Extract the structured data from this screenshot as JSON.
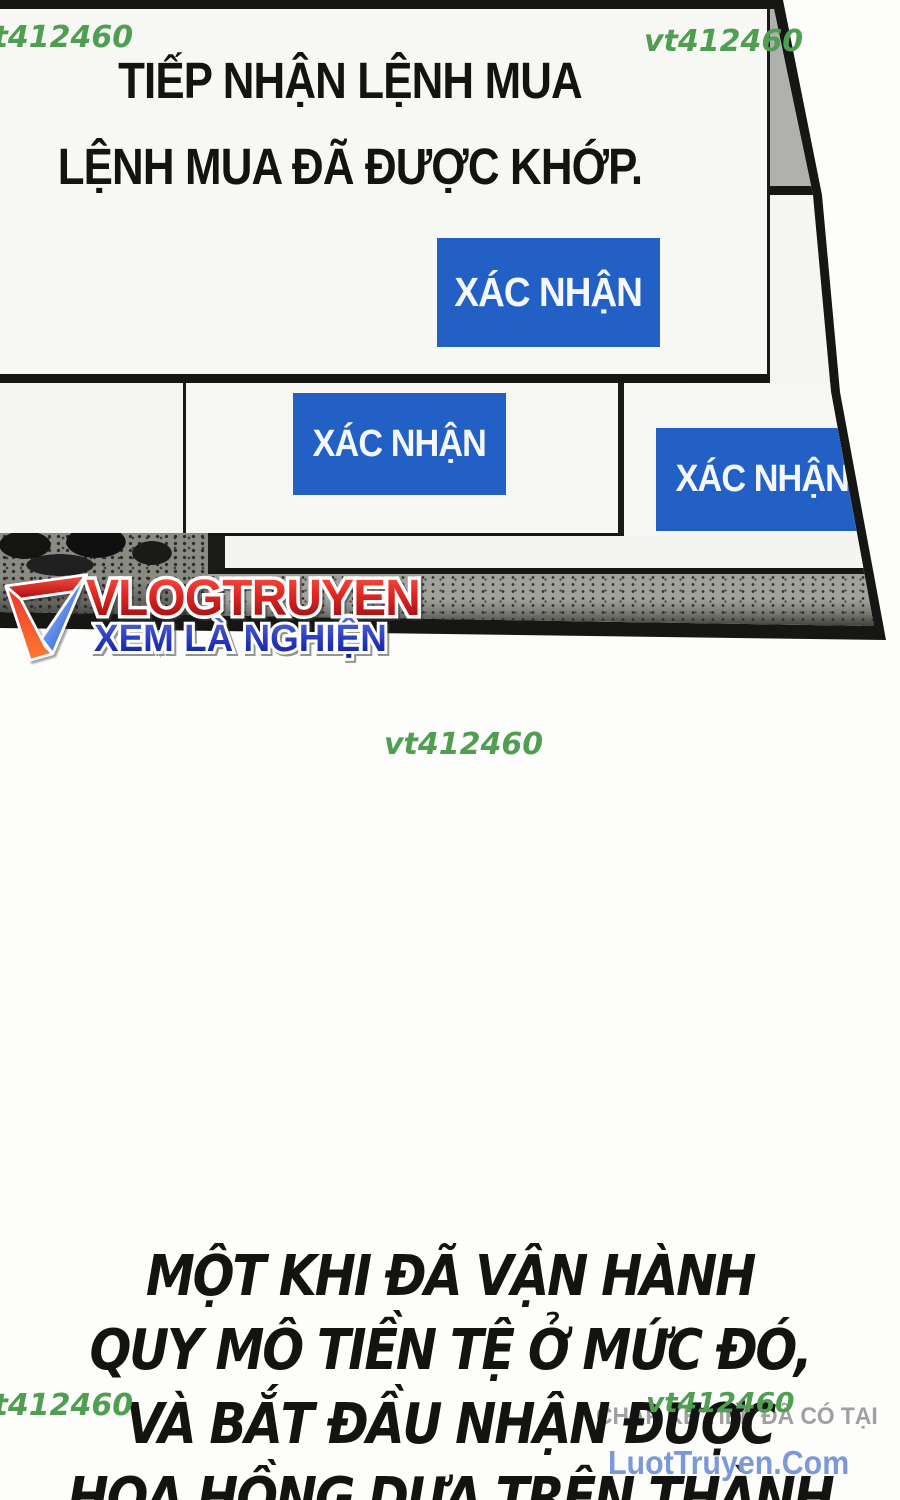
{
  "watermark": {
    "text": "vt412460",
    "color": "#4f9e51"
  },
  "popup": {
    "title_line1": "TIẾP NHẬN LỆNH MUA",
    "title_line2": "LỆNH MUA ĐÃ ĐƯỢC KHỚP.",
    "confirm_label": "XÁC NHẬN",
    "button_color": "#2360c6"
  },
  "logo": {
    "title": "VLOGTRUYEN",
    "tagline": "XEM LÀ NGHIỆN",
    "title_color": "#c4161b",
    "tagline_color": "#1c2fae"
  },
  "promo": {
    "heading": "CHAP KẾ TIẾP ĐÃ CÓ TẠI",
    "site": "LuotTruyen.Com",
    "heading_color": "#a0a0a0",
    "site_color": "#7b98d8"
  },
  "narration": {
    "lines": [
      "MỘT KHI ĐÃ VẬN HÀNH",
      "QUY MÔ TIỀN TỆ Ở MỨC ĐÓ,",
      "VÀ BẮT ĐẦU NHẬN ĐƯỢC",
      "HOA HỒNG DỰA TRÊN THÀNH"
    ]
  }
}
